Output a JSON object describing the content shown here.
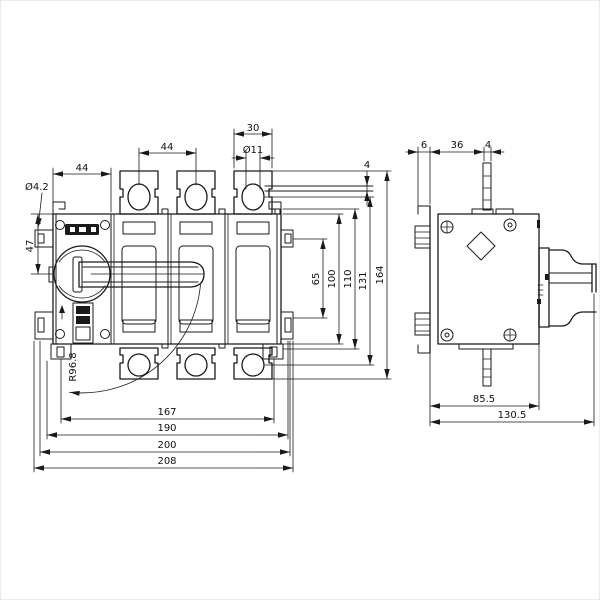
{
  "drawing_labels": {
    "front": {
      "mech_width": "44",
      "pole_pitch": "44",
      "terminal_width": "30",
      "terminal_hole": "Ø11",
      "mount_hole": "Ø4.2",
      "handle_center": "47",
      "lug_thickness": "4",
      "clip_span": "65",
      "body_height": "100",
      "mid_height": "110",
      "hole_span": "131",
      "overall_height": "164",
      "slot_span": "167",
      "width_190": "190",
      "width_200": "200",
      "overall_width": "208",
      "swing_radius": "R96.8"
    },
    "side": {
      "rail_gap": "6",
      "stud_offset": "36",
      "stud_width": "4",
      "body_depth": "85.5",
      "overall_depth": "130.5"
    }
  },
  "colors": {
    "line": "#1a1a1a",
    "paper": "#ffffff"
  }
}
